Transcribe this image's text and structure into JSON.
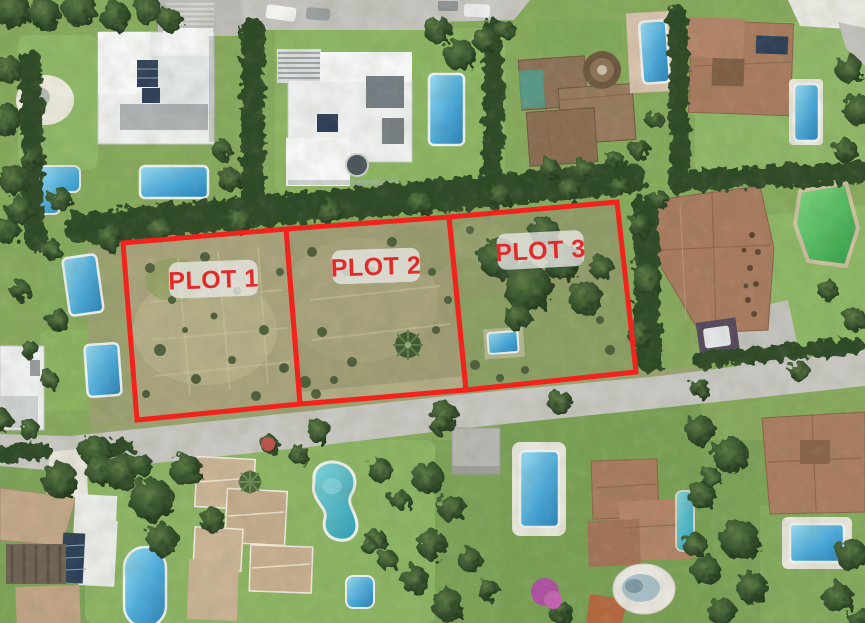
{
  "image": {
    "description": "Aerial satellite photo of a residential villa neighborhood with pools; three adjacent vacant land plots in the middle are outlined in red and labelled."
  },
  "plots": [
    {
      "id": "plot-1",
      "label": "PLOT 1"
    },
    {
      "id": "plot-2",
      "label": "PLOT 2"
    },
    {
      "id": "plot-3",
      "label": "PLOT 3"
    }
  ],
  "colors": {
    "plot_outline": "#f2231d",
    "label_text": "#e32a2b",
    "label_bg": "#e8e8e6"
  }
}
